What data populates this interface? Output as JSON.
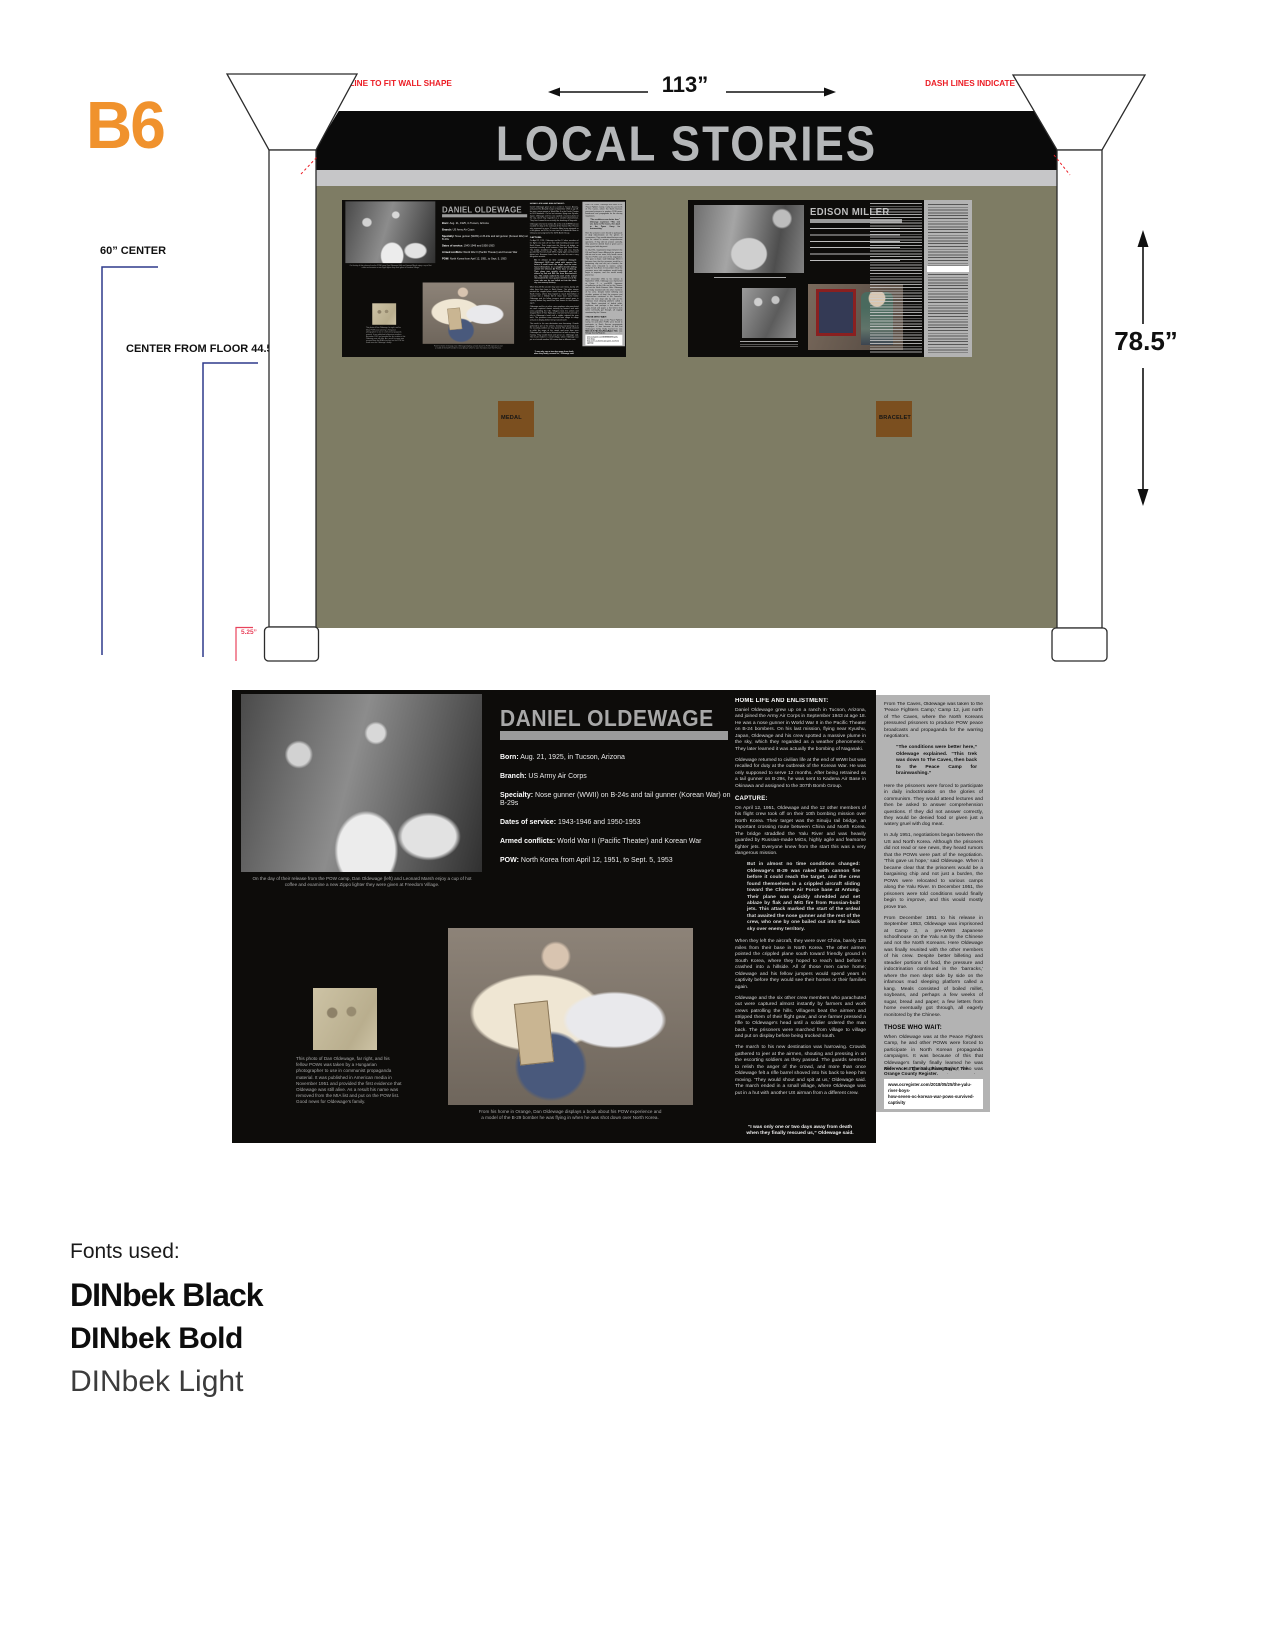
{
  "sheet": {
    "label": "B6"
  },
  "annotations": {
    "cutline_note": "DASH LINES INDICATE CUT-LINE TO FIT WALL SHAPE",
    "width_dim": "113”",
    "height_dim": "78.5”",
    "center_note": "60” CENTER",
    "floor_note": "CENTER FROM FLOOR 44.5”",
    "base_dim": "5.25”"
  },
  "wall": {
    "header_title": "LOCAL STORIES",
    "artifacts": {
      "medal": "MEDAL",
      "bracelet": "BRACELET"
    },
    "panel_titles": {
      "daniel": "DANIEL OLDEWAGE",
      "edison": "EDISON MILLER"
    }
  },
  "panel": {
    "title": "DANIEL OLDEWAGE",
    "bio": [
      {
        "label": "Born:",
        "rest": "Aug. 21, 1925, in Tucson, Arizona"
      },
      {
        "label": "Branch:",
        "rest": "US Army Air Corps"
      },
      {
        "label": "Specialty:",
        "rest": "Nose gunner (WWII) on B-24s and tail gunner (Korean War) on B-29s"
      },
      {
        "label": "Dates of service:",
        "rest": "1943-1946 and 1950-1953"
      },
      {
        "label": "Armed conflicts:",
        "rest": "World War II (Pacific Theater) and Korean War"
      },
      {
        "label": "POW:",
        "rest": "North Korea from April 12, 1951, to Sept. 5, 1953"
      }
    ],
    "captions": {
      "release_photo": "On the day of their release from the POW camp, Dan Oldewage (left) and Leonard Marsh enjoy a cup of hot coffee and examine a new Zippo lighter they were given at Freedom Village.",
      "clipping": "This photo of Dan Oldewage, far right, and his fellow POWs was taken by a Hungarian photographer to use in communist propaganda material. It was published in American media in November 1951 and provided the first evidence that Oldewage was still alive. As a result his name was removed from the MIA list and put on the POW list. Good news for Oldewage's family.",
      "home_photo": "From his home in Orange, Dan Oldewage displays a book about his POW experience and a model of the B-29 bomber he was flying in when he was shot down over North Korea."
    },
    "column_a": [
      {
        "type": "heading",
        "text": "HOME LIFE AND ENLISTMENT:"
      },
      {
        "type": "para",
        "text": "Daniel Oldewage grew up on a ranch in Tucson, Arizona, and joined the Army Air Corps in September 1943 at age 18. He was a nose gunner in World War II in the Pacific Theater on B-24 bombers. On his last mission, flying near Kyushu, Japan, Oldewage and his crew spotted a massive plume in the sky, which they regarded as a weather phenomenon. They later learned it was actually the bombing of Nagasaki."
      },
      {
        "type": "para",
        "text": "Oldewage returned to civilian life at the end of WWII but was recalled for duty at the outbreak of the Korean War. He was only supposed to serve 12 months. After being retrained as a tail gunner on B-29s, he was sent to Kadena Air Base in Okinawa and assigned to the 307th Bomb Group."
      },
      {
        "type": "heading",
        "text": "CAPTURE:"
      },
      {
        "type": "para",
        "text": "On April 12, 1951, Oldewage and the 12 other members of his flight crew took off on their 10th bombing mission over North Korea. Their target was the Sinuiju rail bridge, an important crossing route between China and North Korea. The bridge straddled the Yalu River and was heavily guarded by Russian-made MiGs, highly agile and fearsome fighter jets. Everyone knew from the start this was a very dangerous mission."
      },
      {
        "type": "blockquote",
        "text": "But in almost no time conditions changed: Oldewage's B-29 was raked with cannon fire before it could reach the target, and the crew found themselves in a crippled aircraft sliding toward the Chinese Air Force base at Antung. Their plane was quickly shredded and set ablaze by flak and MiG fire from Russian-built jets. This attack marked the start of the ordeal that awaited the nose gunner and the rest of the crew, who one by one bailed out into the black sky over enemy territory."
      },
      {
        "type": "para",
        "text": "When they left the aircraft, they were over China, barely 125 miles from their base in North Korea. The other airmen pointed the crippled plane south toward friendly ground in South Korea, where they hoped to reach land before it crashed into a hillside. All of those men came home; Oldewage and his fellow jumpers would spend years in captivity before they would see their homes or their families again."
      },
      {
        "type": "para",
        "text": "Oldewage and the six other crew members who parachuted out were captured almost instantly by farmers and work crews patrolling the hills. Villagers beat the airmen and stripped them of their flight gear, and one farmer pressed a rifle to Oldewage's head until a soldier ordered the man back. The prisoners were marched from village to village and put on display before being trucked south."
      },
      {
        "type": "para",
        "text": "The march to his new destination was harrowing. Crowds gathered to jeer at the airmen, shouting and pressing in on the escorting soldiers as they passed. The guards seemed to relish the anger of the crowd, and more than once Oldewage felt a rifle barrel shoved into his back to keep him moving. 'They would shout and spit at us,' Oldewage said. The march ended in a small village, where Oldewage was put in a hut with another US airman from a different crew."
      },
      {
        "type": "heading",
        "text": "PRISON LIFE:"
      },
      {
        "type": "para",
        "text": "Oldewage was eventually taken near China, where he was reunited with his crew. Here he was interrogated by Russian, Chinese and Korean officers. 'The Russians were not rough, but the Chinese and the Koreans were.' As punishment for not cooperating with the enemy, Oldewage and his crew were marched across the Sinuiju rail bridge, which had survived the bombing raids, and were transported to Pyongyang."
      },
      {
        "type": "para",
        "text": "They were then marched through the night to a propaganda camp called 'The Caves,' a warren of old bomb-shelter tunnels dug into a hillside outside Pyongyang, known as the worst POW camp in the North. The men slept packed together on damp clay floors in darkness, and this is where many began to die."
      },
      {
        "type": "para",
        "text": "The conditions here were completely unsanitary. When it rained, mud contaminated by human waste leaked into their cells. There were no blankets, running water or toilets. Many men were too weak and sick to crawl outside to relieve themselves, so they lay in their own waste. The stench of death and decay hung all around them. They were fed a handful of indigestible grain twice a day and soap was a luxury. The prisoners suffered from malnutrition, mental confusion, dysentery, beriberi, hepatitis, anemia, malaria and other diseases. Each day, three to four prisoners would die in the caves. Oldewage was imprisoned here for nearly three months and dropped from his original weight of 170 pounds to just 85 pounds."
      }
    ],
    "column_a_quote": "“I was only one or two days away from death when they finally rescued us,” Oldewage said.",
    "column_b": [
      {
        "type": "para",
        "text": "From The Caves, Oldewage was taken to the 'Peace Fighters Camp,' Camp 12, just north of The Caves, where the North Koreans pressured prisoners to produce POW peace broadcasts and propaganda for the warring negotiators."
      },
      {
        "type": "blockquote",
        "text": "“The conditions were better here,” Oldewage explained. “This trek was down to The Caves, then back to the Peace Camp for brainwashing.”"
      },
      {
        "type": "para",
        "text": "Here the prisoners were forced to participate in daily indoctrination on the glories of communism. They would attend lectures and then be asked to answer comprehension questions. If they did not answer correctly, they would be denied food or given just a watery gruel with dog meat."
      },
      {
        "type": "para",
        "text": "In July 1951, negotiations began between the US and North Korea. Although the prisoners did not read or see news, they heard rumors that the POWs were part of the negotiation. 'This gave us hope,' said Oldewage. When it became clear that the prisoners would be a bargaining chip and not just a burden, the POWs were relocated to various camps along the Yalu River. In December 1951, the prisoners were told conditions would finally begin to improve, and this would mostly prove true."
      },
      {
        "type": "para",
        "text": "From December 1951 to his release in September 1953, Oldewage was imprisoned at Camp 2, a pre-WWII Japanese schoolhouse on the Yalu run by the Chinese and not the North Koreans. Here Oldewage was finally reunited with the other members of his crew. Despite better billeting and steadier portions of food, the pressure and indoctrination continued in the 'barracks,' where the men slept side by side on the infamous mud sleeping platform called a kang. Meals consisted of boiled millet, soybeans, and perhaps a few weeks of sugar, bread and paper; a few letters from home eventually got through, all eagerly monitored by the Chinese."
      },
      {
        "type": "heading",
        "text": "THOSE WHO WAIT:"
      },
      {
        "type": "para",
        "text": "When Oldewage was at the Peace Fighters Camp, he and other POWs were forced to participate in North Korean propaganda campaigns. It was because of this that Oldewage's family finally learned he was alive. A Hungarian photographer, who was helping the communists produce propaganda, photographed Oldewage and his fellow POWs, and the image ran in American media in November 1951 — the first proof in seven months that he had survived being shot down."
      },
      {
        "type": "para",
        "text": "One thing that kept Oldewage going during his time in captivity was thinking about his family back home — his mother, father and five siblings. He worried the most about his mother, who was in her 70s at the time of his imprisonment. Although she lived to see her son freed, she died six months after he came home. 'She was a good mother,' he said."
      },
      {
        "type": "heading",
        "text": "FREEDOM:"
      },
      {
        "type": "para",
        "text": "In September 1953, the US and South Korea began a POW exchange called Operation Big Switch. For Oldewage, the journey home began on Aug. 17, when the men from Camp 2 were loaded first onto trucks and then onto rail cars, where they were transported to a holding camp near Kaesong. Each day, the men would fall out for formation and the names of those who would be released that day were called. On Sept. 5, after weeks of anticipation, Oldewage's name was called and he crossed over Freedom Bridge and into Freedom Village. 'Independence,' Oldewage said."
      },
      {
        "type": "para",
        "text": "At Freedom Village, the newly freed POWs were dusted with pesticide, evaluated by medical staff, processed by admin clerks, interviewed by intelligence officers, and finally given a proper meal. 'We had a hard time adjusting to the rich food,' Oldewage recalled. The final leg of his trip was a sea voyage to San Francisco, during which time he and the other POWs settled back into a routine."
      },
      {
        "type": "para",
        "text": "Despite the tremendous hardships Oldewage faced during his 2½ years in captivity, he said the experience had 'a favorable impact' on his life. 'I learned at the perfect age. Not much bothers me now, much,' he said. The hardest part was the experience he brought home and how slowly it let go of him."
      },
      {
        "type": "para",
        "text": "Oldewage met his future wife just a few months after returning from Korea. They settled in Santa Ana, had three children and were married for 61 years. Oldewage ran his own aircraft supply company until he retired in Orange. At age 93, he remains active and is a volunteer docent at the Lyon Air Museum. Oldewage is the last remaining survivor of his B-29 crew."
      }
    ],
    "column_b_reference": "Reference: “The Yalu River Boys,” The Orange County Register.",
    "column_b_citation_1": "www.ocregister.com/2018/05/25/the-yalu-river-boys-",
    "column_b_citation_2": "how-seven-oc-korean-war-pows-survived-captivity"
  },
  "fonts_section": {
    "heading": "Fonts used:",
    "items": [
      "DINbek Black",
      "DINbek Bold",
      "DINbek Light"
    ]
  },
  "colors": {
    "accent_orange": "#F0922D",
    "annotation_red": "#EC1C24",
    "bracket_red": "#E8435C",
    "dimension_blue": "#2E3A8C",
    "wall_olive": "#7E7C64",
    "column_gray": "#B3B3B3",
    "artifact_brown": "#7B4F1F",
    "panel_black": "#0D0C0A",
    "header_title_gray": "#B5B7B9"
  }
}
